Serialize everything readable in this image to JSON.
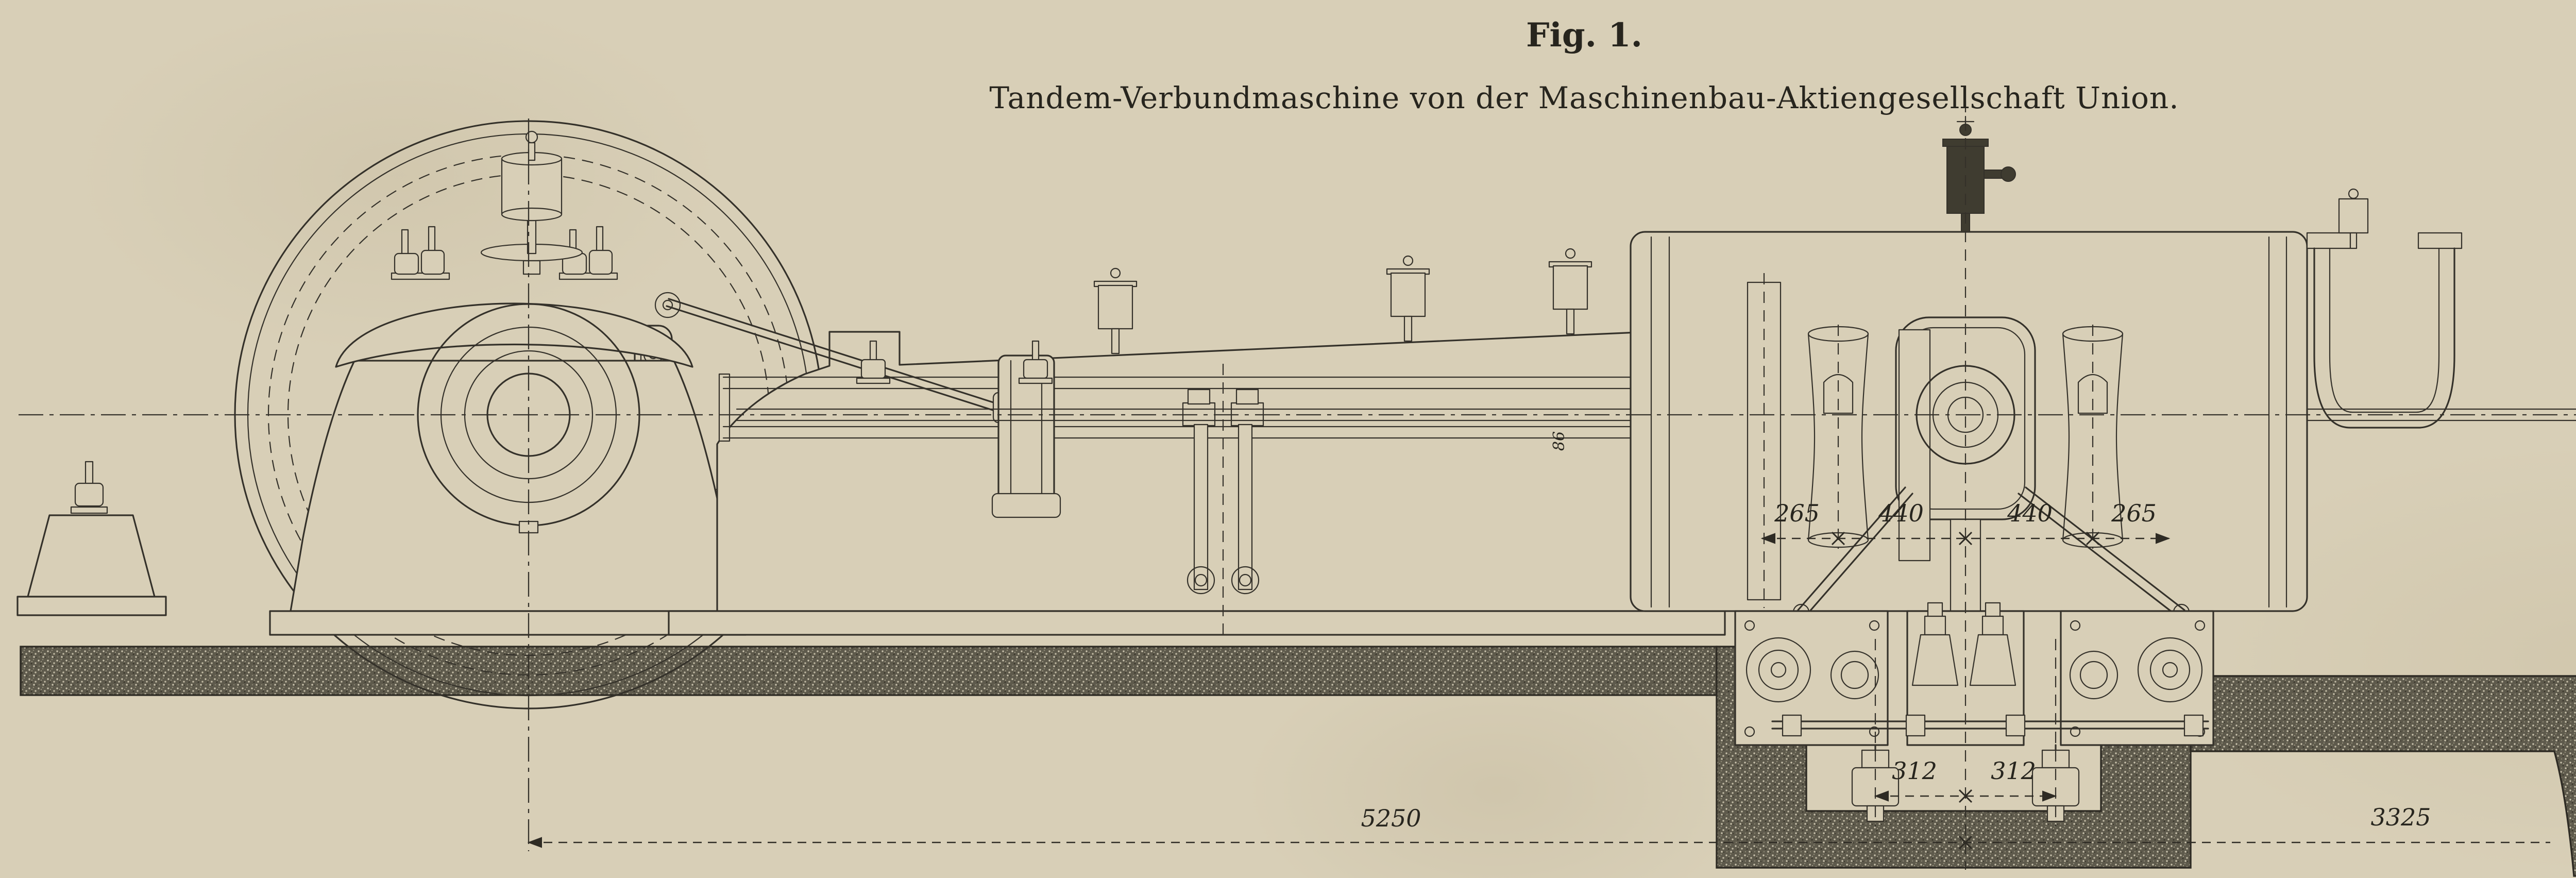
{
  "figure": {
    "fig_label": "Fig. 1.",
    "title": "Tandem-Verbundmaschine von der Maschinenbau-Aktiengesellschaft Union."
  },
  "dims": {
    "gov": [
      "570",
      "570"
    ],
    "valve": [
      "265",
      "440",
      "440",
      "265"
    ],
    "pit": [
      "312",
      "312"
    ],
    "lp": [
      "635",
      "635"
    ],
    "base": [
      "5250",
      "3325",
      "1200"
    ],
    "pedestal_height": "800",
    "rod": "86"
  },
  "colors": {
    "paper": "#d8cfb7",
    "ink": "#34312a",
    "masonry": "#5e5a4c"
  }
}
